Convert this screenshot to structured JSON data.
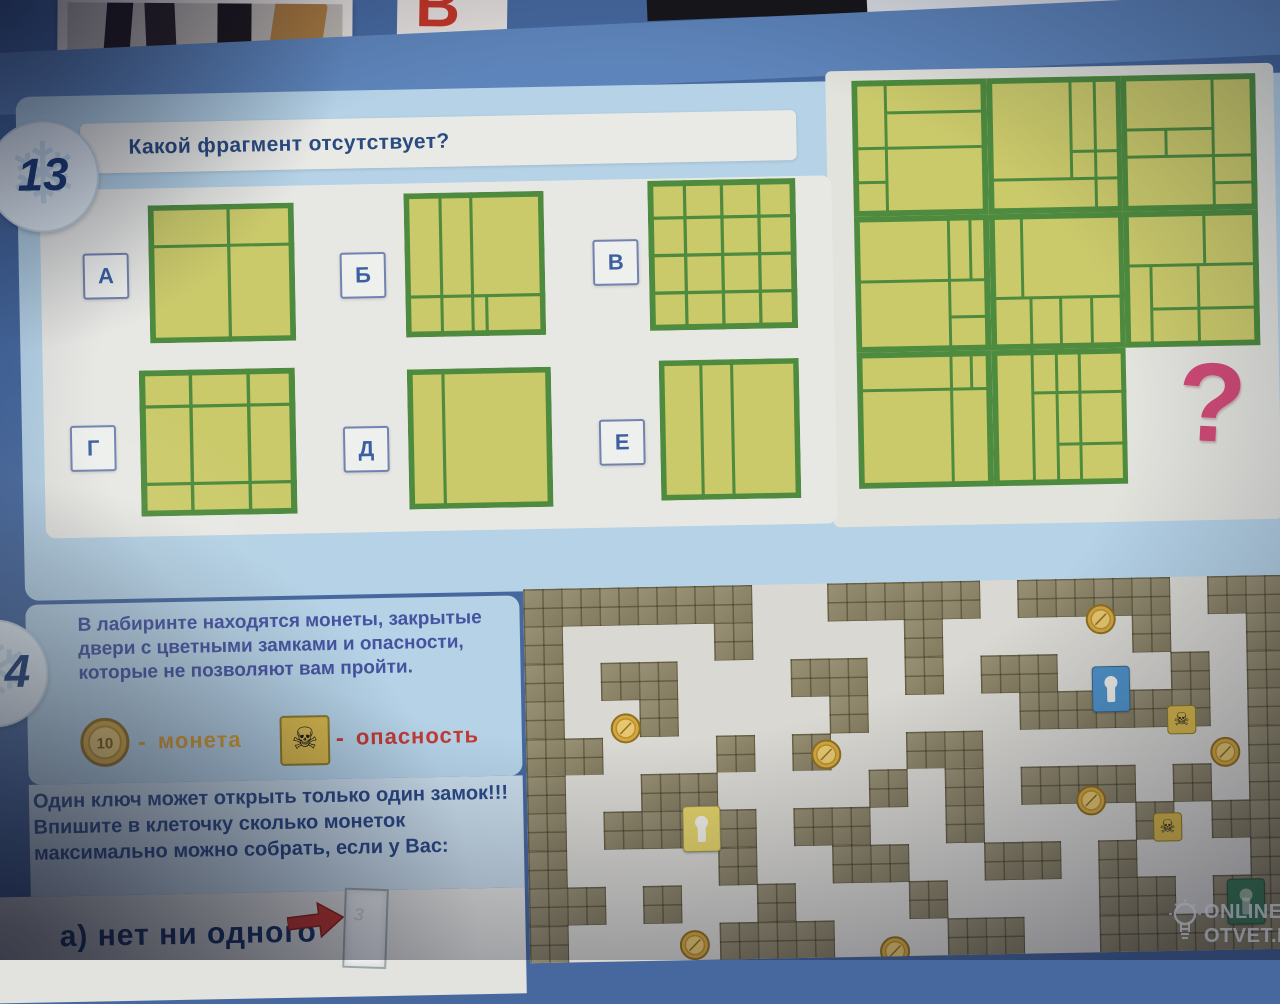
{
  "page": {
    "top": {
      "red_glyph": "В"
    },
    "puzzle13": {
      "badge": "13",
      "title": "Какой фрагмент отсутствует?",
      "question_mark": "?",
      "option_labels": [
        "А",
        "Б",
        "В",
        "Г",
        "Д",
        "Е"
      ]
    },
    "puzzle14": {
      "badge": "4",
      "intro": "В лабиринте находятся монеты, закрытые двери с цветными замками и опасности, которые не позволяют вам пройти.",
      "legend": {
        "coin_value": "10",
        "dash": "-",
        "coin_label": "монета",
        "skull_glyph": "☠",
        "danger_label": "опасность"
      },
      "rule": "Один ключ может открыть только один замок!!!  Впишите в клеточку сколько монеток максимально можно собрать, если у Вас:",
      "item_a": "а) нет ни одного"
    },
    "watermark": {
      "line1": "ONLINE",
      "line2": "OTVET.RU"
    },
    "colors": {
      "accent_pink": "#cf4a76",
      "grid_green": "#4e8b3e",
      "grid_yellow": "#cbca6b",
      "danger_red": "#c23b35",
      "coin_gold": "#d4a83f",
      "lock_blue": "#4f93c9",
      "lock_yellow": "#e3d36a",
      "lock_green": "#3d7a55"
    }
  },
  "grids": {
    "options": [
      {
        "id": "А",
        "lines": [
          [
            55,
            0,
            55,
            100
          ],
          [
            0,
            30,
            100,
            30
          ]
        ]
      },
      {
        "id": "Б",
        "lines": [
          [
            26,
            0,
            26,
            100
          ],
          [
            48,
            0,
            48,
            100
          ],
          [
            0,
            72,
            100,
            72
          ],
          [
            58,
            72,
            58,
            100
          ]
        ]
      },
      {
        "id": "В",
        "lines": [
          [
            25,
            0,
            25,
            100
          ],
          [
            50,
            0,
            50,
            100
          ],
          [
            75,
            0,
            75,
            100
          ],
          [
            0,
            25,
            100,
            25
          ],
          [
            0,
            50,
            100,
            50
          ],
          [
            0,
            75,
            100,
            75
          ]
        ]
      },
      {
        "id": "Г",
        "lines": [
          [
            33,
            0,
            33,
            100
          ],
          [
            70,
            0,
            70,
            100
          ],
          [
            0,
            25,
            100,
            25
          ],
          [
            0,
            78,
            100,
            78
          ]
        ]
      },
      {
        "id": "Д",
        "lines": [
          [
            25,
            0,
            25,
            100
          ]
        ]
      },
      {
        "id": "Е",
        "lines": [
          [
            30,
            0,
            30,
            100
          ],
          [
            52,
            0,
            52,
            100
          ]
        ]
      }
    ],
    "big": {
      "rows": 3,
      "cols": 3,
      "missing": [
        2,
        2
      ],
      "tiles": [
        {
          "r": 0,
          "c": 0,
          "lines": [
            [
              25,
              0,
              25,
              100
            ],
            [
              25,
              24,
              100,
              24
            ],
            [
              0,
              50,
              100,
              50
            ],
            [
              0,
              75,
              25,
              75
            ]
          ]
        },
        {
          "r": 0,
          "c": 1,
          "lines": [
            [
              62,
              0,
              62,
              75
            ],
            [
              80,
              0,
              80,
              100
            ],
            [
              62,
              55,
              100,
              55
            ],
            [
              0,
              75,
              100,
              75
            ]
          ]
        },
        {
          "r": 0,
          "c": 2,
          "lines": [
            [
              68,
              0,
              68,
              100
            ],
            [
              0,
              40,
              68,
              40
            ],
            [
              0,
              60,
              100,
              60
            ],
            [
              33,
              40,
              33,
              60
            ],
            [
              68,
              80,
              100,
              80
            ]
          ]
        },
        {
          "r": 1,
          "c": 0,
          "lines": [
            [
              70,
              0,
              70,
              100
            ],
            [
              86,
              0,
              86,
              48
            ],
            [
              0,
              48,
              100,
              48
            ],
            [
              70,
              75,
              100,
              75
            ]
          ]
        },
        {
          "r": 1,
          "c": 1,
          "lines": [
            [
              24,
              0,
              24,
              62
            ],
            [
              0,
              62,
              100,
              62
            ],
            [
              30,
              62,
              30,
              100
            ],
            [
              52,
              62,
              52,
              100
            ],
            [
              75,
              62,
              75,
              100
            ]
          ]
        },
        {
          "r": 1,
          "c": 2,
          "lines": [
            [
              0,
              40,
              100,
              40
            ],
            [
              60,
              0,
              60,
              40
            ],
            [
              20,
              40,
              20,
              100
            ],
            [
              55,
              40,
              55,
              100
            ],
            [
              20,
              72,
              100,
              72
            ]
          ]
        },
        {
          "r": 2,
          "c": 0,
          "lines": [
            [
              0,
              28,
              100,
              28
            ],
            [
              70,
              0,
              70,
              100
            ],
            [
              85,
              0,
              85,
              28
            ]
          ]
        },
        {
          "r": 2,
          "c": 1,
          "lines": [
            [
              30,
              0,
              30,
              100
            ],
            [
              48,
              0,
              48,
              100
            ],
            [
              65,
              0,
              65,
              100
            ],
            [
              30,
              32,
              100,
              32
            ],
            [
              48,
              70,
              100,
              70
            ]
          ]
        }
      ]
    }
  },
  "maze": {
    "map": [
      "######..####.####.##",
      "#....#....#.....#..#",
      "#.##...##.#.##...#.#",
      "#..#....#....#####.#",
      "##...#.#..##.......#",
      "#..##....#.#.###.#.#",
      "#.####.##..#....#.##",
      "#....#..##..##.#...#",
      "##.#..#...#....##.##",
      "#....###...##..#####"
    ],
    "items": [
      {
        "type": "coin",
        "x": 13.2,
        "y": 37.7
      },
      {
        "type": "coin",
        "x": 39.5,
        "y": 45.7
      },
      {
        "type": "coin",
        "x": 75.9,
        "y": 11.0
      },
      {
        "type": "coin",
        "x": 92.0,
        "y": 47.1
      },
      {
        "type": "coin",
        "x": 74.2,
        "y": 59.4
      },
      {
        "type": "coin",
        "x": 21.7,
        "y": 96.0
      },
      {
        "type": "coin",
        "x": 48.0,
        "y": 98.7
      },
      {
        "type": "skull",
        "x": 86.3,
        "y": 38.2
      },
      {
        "type": "skull",
        "x": 84.2,
        "y": 66.8
      },
      {
        "type": "lock",
        "color": "#4f93c9",
        "dim": false,
        "x": 77.1,
        "y": 29.7
      },
      {
        "type": "lock",
        "color": "#e3d36a",
        "dim": false,
        "x": 22.9,
        "y": 65.0
      },
      {
        "type": "lock",
        "color": "#3d7a55",
        "dim": true,
        "x": 94.3,
        "y": 87.2
      }
    ]
  }
}
